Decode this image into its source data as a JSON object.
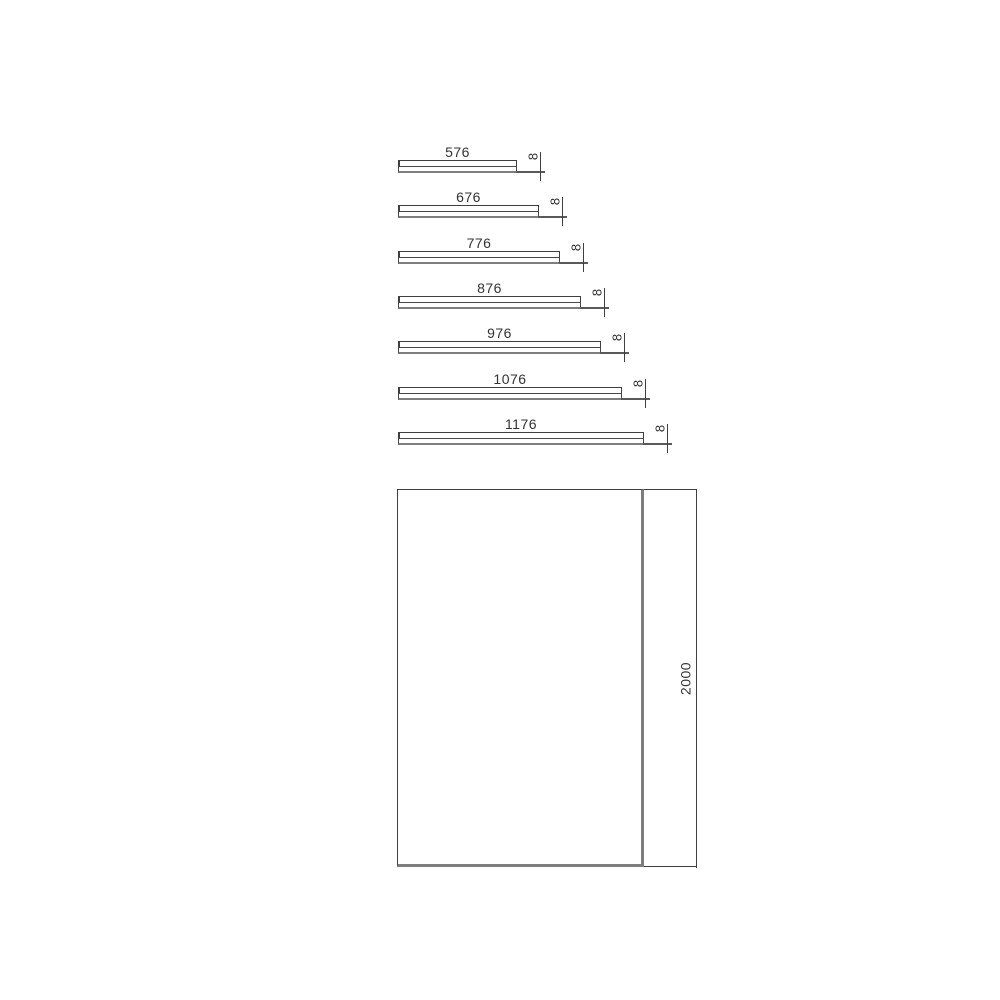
{
  "colors": {
    "background": "#ffffff",
    "thin_line": "#3f3f3f",
    "thick_line": "#7e7e7e",
    "text": "#333333"
  },
  "diagram": {
    "panels": [
      {
        "width_label": "576",
        "thickness_label": "8"
      },
      {
        "width_label": "676",
        "thickness_label": "8"
      },
      {
        "width_label": "776",
        "thickness_label": "8"
      },
      {
        "width_label": "876",
        "thickness_label": "8"
      },
      {
        "width_label": "976",
        "thickness_label": "8"
      },
      {
        "width_label": "1076",
        "thickness_label": "8"
      },
      {
        "width_label": "1176",
        "thickness_label": "8"
      }
    ],
    "front_panel": {
      "height_label": "2000"
    }
  }
}
